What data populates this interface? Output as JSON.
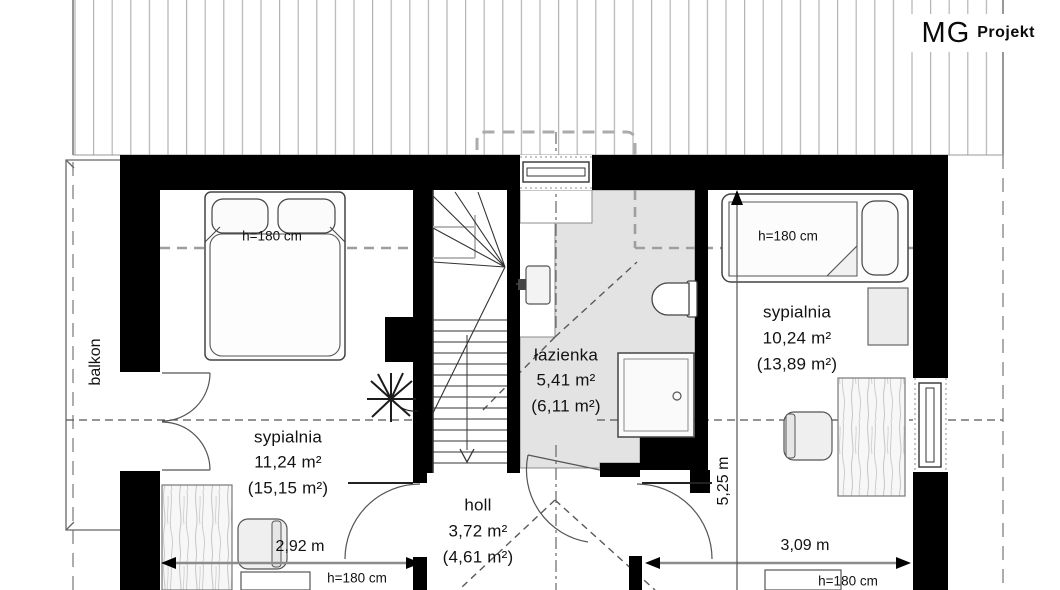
{
  "logo": {
    "mg": "MG",
    "projekt": "Projekt"
  },
  "labels": {
    "balcony": "balkon"
  },
  "rooms": [
    {
      "name": "sypialnia",
      "area": "11,24 m²",
      "area_gross": "(15,15 m²)"
    },
    {
      "name": "holl",
      "area": "3,72 m²",
      "area_gross": "(4,61 m²)"
    },
    {
      "name": "łazienka",
      "area": "5,41 m²",
      "area_gross": "(6,11 m²)"
    },
    {
      "name": "sypialnia",
      "area": "10,24 m²",
      "area_gross": "(13,89 m²)"
    }
  ],
  "dimensions": {
    "bottom_left": "2,92 m",
    "bottom_right": "3,09 m",
    "right_vertical": "5,25 m"
  },
  "height_labels": {
    "bed_left": "h=180 cm",
    "bed_right": "h=180 cm",
    "bottom_left": "h=180 cm",
    "bottom_right": "h=180 cm"
  },
  "colors": {
    "wall": "#000000",
    "bathroom_floor": "#e3e3e3",
    "roof_hatch": "#b4b4b4"
  }
}
